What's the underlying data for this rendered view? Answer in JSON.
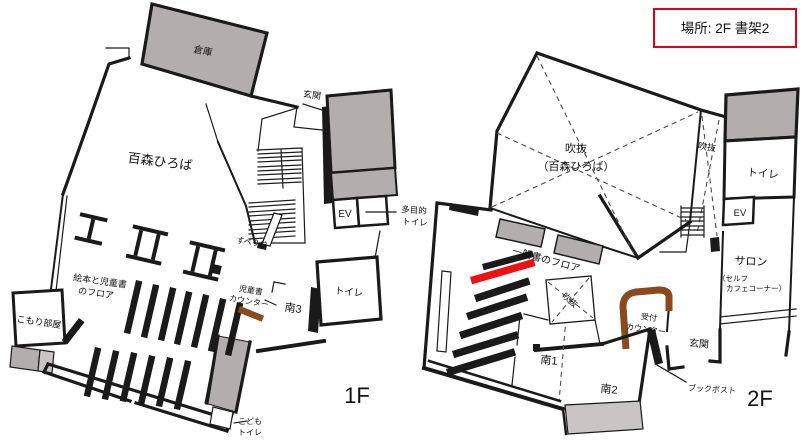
{
  "legend": {
    "location_text": "場所: 2F 書架2"
  },
  "colors": {
    "wall": "#1a1a1a",
    "room_fill_gray": "#b3aeae",
    "terrace_gray": "#c9c5c5",
    "counter_brown": "#8a4a1f",
    "highlight_red": "#ee1111",
    "legend_red": "#e60012"
  },
  "floor1": {
    "floor_label": "1F",
    "rooms": {
      "souko": "倉庫",
      "genkan": "玄関",
      "hiroba": "百森ひろば",
      "ev": "EV",
      "tamokuteki_line1": "多目的",
      "tamokuteki_line2": "トイレ",
      "suberidai": "すべり台",
      "ehon_line1": "絵本と児童書",
      "ehon_line2": "のフロア",
      "jido_counter_line1": "児童書",
      "jido_counter_line2": "カウンター",
      "komori": "こもり部屋",
      "minami3": "南3",
      "toilet": "トイレ",
      "kodomo_line1": "こども",
      "kodomo_line2": "トイレ"
    }
  },
  "floor2": {
    "floor_label": "2F",
    "rooms": {
      "fukinuke_line1": "吹抜",
      "fukinuke_line2": "（百森ひろば）",
      "fukinuke_right": "吹抜",
      "toilet": "トイレ",
      "ev": "EV",
      "salon": "サロン",
      "salon_sub1": "（セルフ",
      "salon_sub2": "カフェコーナー）",
      "ippansho": "一般書のフロア",
      "fukinuke_center": "吹抜",
      "uketsuke_line1": "受付",
      "uketsuke_line2": "カウンター",
      "genkan": "玄関",
      "minami1": "南1",
      "minami2": "南2",
      "bookpost": "ブックポスト"
    }
  }
}
